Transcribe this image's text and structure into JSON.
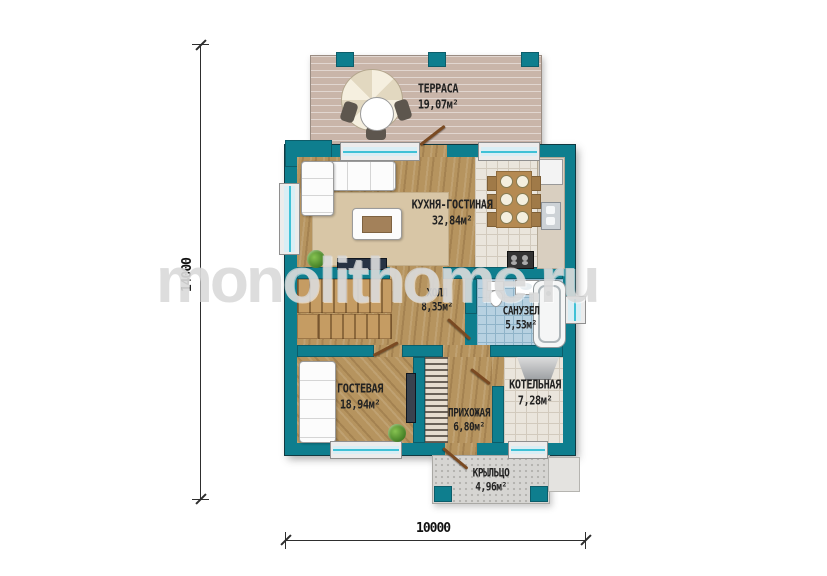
{
  "plan": {
    "watermark": "monolithome.ru",
    "dimensions": {
      "vertical": "14000",
      "horizontal": "10000"
    },
    "rooms": {
      "terrace": {
        "name": "ТЕРРАСА",
        "area": "19,07м²"
      },
      "kitchen_living": {
        "name": "КУХНЯ-ГОСТИНАЯ",
        "area": "32,84м²"
      },
      "hall": {
        "name": "ХОЛЛ",
        "area": "8,35м²"
      },
      "bathroom": {
        "name": "САНУЗЕЛ",
        "area": "5,53м²"
      },
      "guest": {
        "name": "ГОСТЕВАЯ",
        "area": "18,94м²"
      },
      "hallway": {
        "name": "ПРИХОЖАЯ",
        "area": "6,80м²"
      },
      "boiler": {
        "name": "КОТЕЛЬНАЯ",
        "area": "7,28м²"
      },
      "porch": {
        "name": "КРЫЛЬЦО",
        "area": "4,96м²"
      }
    },
    "colors": {
      "wall": "#0e7e8e",
      "wood": "#b6945f",
      "tile": "#eae5dc",
      "bath_tile": "#b7d1e1",
      "deck": "#c9b5a9",
      "porch": "#d6d5d2",
      "glass": "#d8eef5",
      "accent": "#3fc1d6",
      "door": "#7a4a22"
    }
  }
}
